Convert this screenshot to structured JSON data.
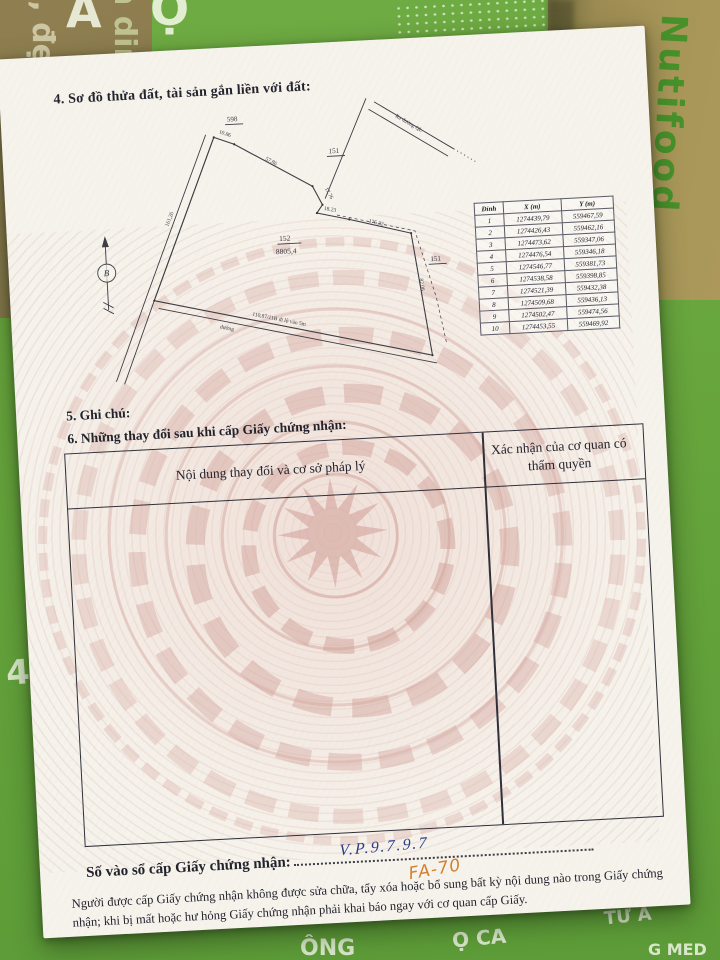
{
  "doc": {
    "section4": "4. Sơ đồ thửa đất, tài sản gắn liền với đất:",
    "section5": "5. Ghi chú:",
    "section6": "6. Những thay đổi sau khi cấp Giấy chứng nhận:",
    "change_table": {
      "col1": "Nội dung thay đổi và cơ sở pháp lý",
      "col2_line1": "Xác nhận của cơ quan có",
      "col2_line2": "thẩm quyền"
    },
    "book_entry": {
      "label": "Số vào sổ cấp Giấy chứng nhận:",
      "handwritten_no": "V.P.9.7.9.7",
      "handwritten_extra": "FA-70"
    },
    "footer": "Người được cấp Giấy chứng nhận không được sửa chữa, tẩy xóa hoặc bổ sung bất kỳ nội dung nào trong Giấy chứng nhận; khi bị mất hoặc hư hỏng Giấy chứng nhận phải khai báo ngay với cơ quan cấp Giấy."
  },
  "diagram": {
    "compass": "B",
    "parcel_number": "152",
    "parcel_area": "8805,4",
    "neighbor_topleft": "598",
    "neighbor_top": "151",
    "neighbor_right": "151",
    "road_right": "Ra đường QL",
    "road_bottom_line1": "110,87/11B đi lộ vào 5m",
    "road_bottom_line2": "đường",
    "len_1": "10.86",
    "len_2": "57.86",
    "len_3": "17.76",
    "len_4": "18.23",
    "len_5": "176.32",
    "len_6": "82.06",
    "len_7": "161,26"
  },
  "coords": {
    "headers": [
      "Đỉnh",
      "X (m)",
      "Y (m)"
    ],
    "rows": [
      [
        "1",
        "1274439,79",
        "559467,59"
      ],
      [
        "2",
        "1274426,43",
        "559462,16"
      ],
      [
        "3",
        "1274473,62",
        "559347,06"
      ],
      [
        "4",
        "1274476,54",
        "559346,18"
      ],
      [
        "5",
        "1274546,77",
        "559381,73"
      ],
      [
        "6",
        "1274538,58",
        "559398,85"
      ],
      [
        "7",
        "1274521,39",
        "559432,38"
      ],
      [
        "8",
        "1274509,68",
        "559436,13"
      ],
      [
        "9",
        "1274502,47",
        "559474,56"
      ],
      [
        "10",
        "1274453,55",
        "559469,92"
      ]
    ]
  },
  "background": {
    "brand_vertical": "Nutifood",
    "box_left_1": "l, đẹp da",
    "box_left_2": "n dinh",
    "lid_letters": [
      "A",
      "Ọ"
    ],
    "frag_4x": "4X",
    "bottom_frags": [
      "ÔNG",
      "Ọ CA",
      "TƯ Á",
      "G MED"
    ]
  }
}
